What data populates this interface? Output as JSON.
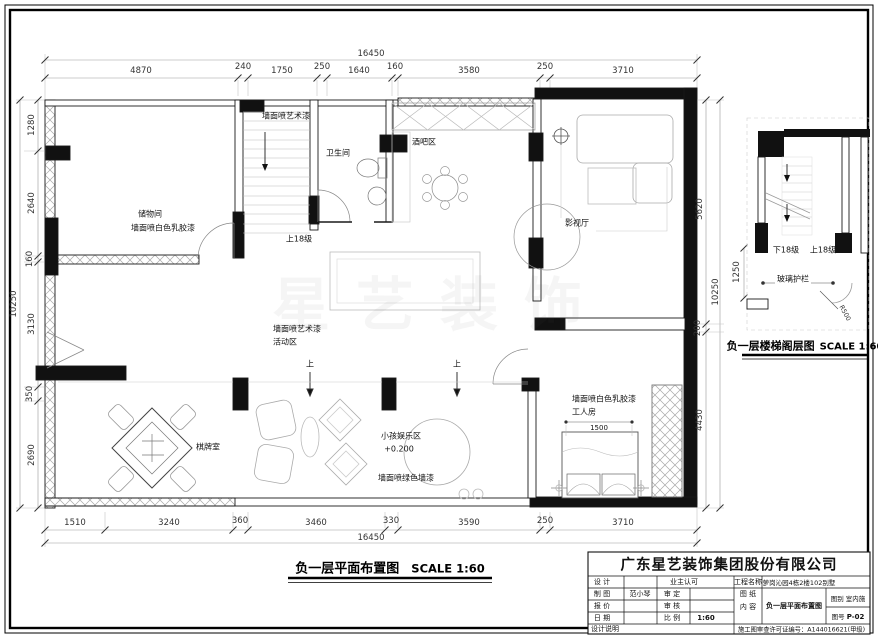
{
  "watermark": "星艺装饰",
  "plan": {
    "title": "负一层平面布置图",
    "scale": "SCALE 1:60",
    "labels": {
      "storage_name": "储物间",
      "storage_finish": "墙面喷白色乳胶漆",
      "stair_finish": "墙面喷艺术漆",
      "stair_up": "上18级",
      "bath": "卫生间",
      "bar": "酒吧区",
      "media": "影视厅",
      "activity_finish": "墙面喷艺术漆",
      "activity_name": "活动区",
      "up_marker_1": "上",
      "up_marker_2": "上",
      "chess": "棋牌室",
      "kids_name": "小孩娱乐区",
      "kids_level": "+0.200",
      "kids_finish": "墙面喷绿色墙漆",
      "worker_finish": "墙面喷白色乳胶漆",
      "worker_name": "工人房",
      "bed_dim": "1500"
    },
    "dims": {
      "top_total": "16450",
      "top": [
        "4870",
        "240",
        "1750",
        "250",
        "1640",
        "160",
        "3580",
        "250",
        "3710"
      ],
      "bottom": [
        "1510",
        "3240",
        "360",
        "3460",
        "330",
        "3590",
        "250",
        "3710"
      ],
      "bottom_total": "16450",
      "left": [
        "1280",
        "2640",
        "160",
        "3130",
        "350",
        "2690"
      ],
      "left_total": "10250",
      "right": [
        "5620",
        "200",
        "4430"
      ],
      "right_total": "10250"
    }
  },
  "stair_detail": {
    "title": "负一层楼梯阁层图",
    "scale": "SCALE 1:60",
    "down_label": "下18级",
    "up_label": "上18级",
    "railing_label": "玻璃护栏",
    "radius_label": "R500",
    "dim_1250": "1250"
  },
  "title_block": {
    "company": "广东星艺装饰集团股份有限公司",
    "design_label": "设 计",
    "owner_ok": "业主认可",
    "draft_label": "制 图",
    "draft_by": "范小琴",
    "approve_label": "审 定",
    "quote_label": "报 价",
    "check_label": "审 核",
    "date_label": "日 期",
    "scale_label": "比 例",
    "scale_value": "1:60",
    "project_label": "工程名称",
    "project_value": "萝岗沁园4栋2楼102别墅",
    "sheet_label_1": "图 纸",
    "sheet_label_2": "内 容",
    "sheet_content": "负一层平面布置图",
    "category_label": "图别",
    "category_value": "室内施",
    "number_label": "图号",
    "number_value": "P-02",
    "notes_label": "设计说明",
    "permit": "施工图审查许可证编号：A144016621(甲级)"
  }
}
